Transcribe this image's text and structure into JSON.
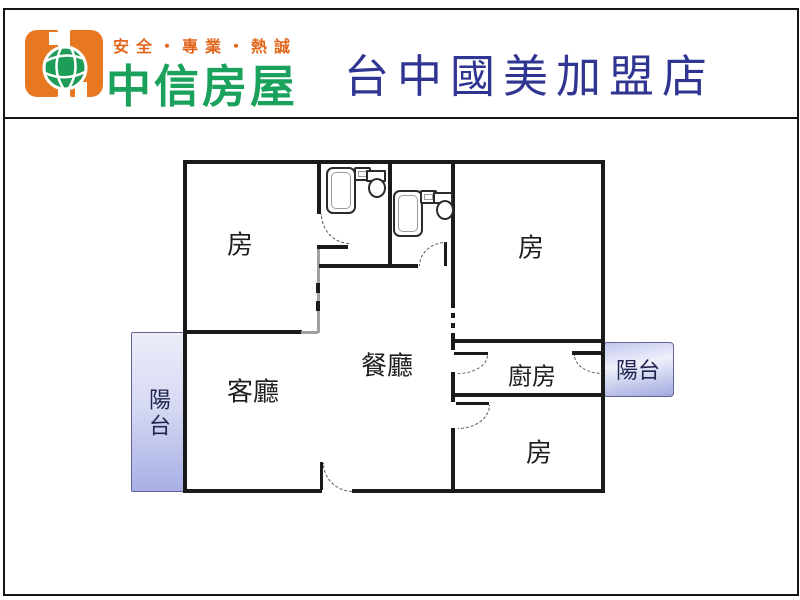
{
  "header": {
    "slogan": "安全・專業・熱誠",
    "brand_name": "中信房屋",
    "store_title": "台中國美加盟店"
  },
  "floorplan": {
    "rooms": {
      "bedroom_top_left": "房",
      "bedroom_top_right": "房",
      "bedroom_bottom_right": "房",
      "living_room": "客廳",
      "dining_room": "餐廳",
      "kitchen": "廚房",
      "balcony_left": "陽台",
      "balcony_right": "陽台"
    }
  },
  "colors": {
    "slogan_orange": "#e2671d",
    "brand_green": "#1aa15c",
    "logo_orange": "#e87722",
    "globe_green": "#1d9d57",
    "title_navy": "#2f3590",
    "wall_black": "#1a1a1a",
    "interior_wall_gray": "#a0a0a0",
    "balcony_fill_light": "#ecedf9",
    "balcony_fill_dark": "#a8afe5",
    "balcony_border": "#63639a",
    "label_ink": "#1f1f1f"
  }
}
